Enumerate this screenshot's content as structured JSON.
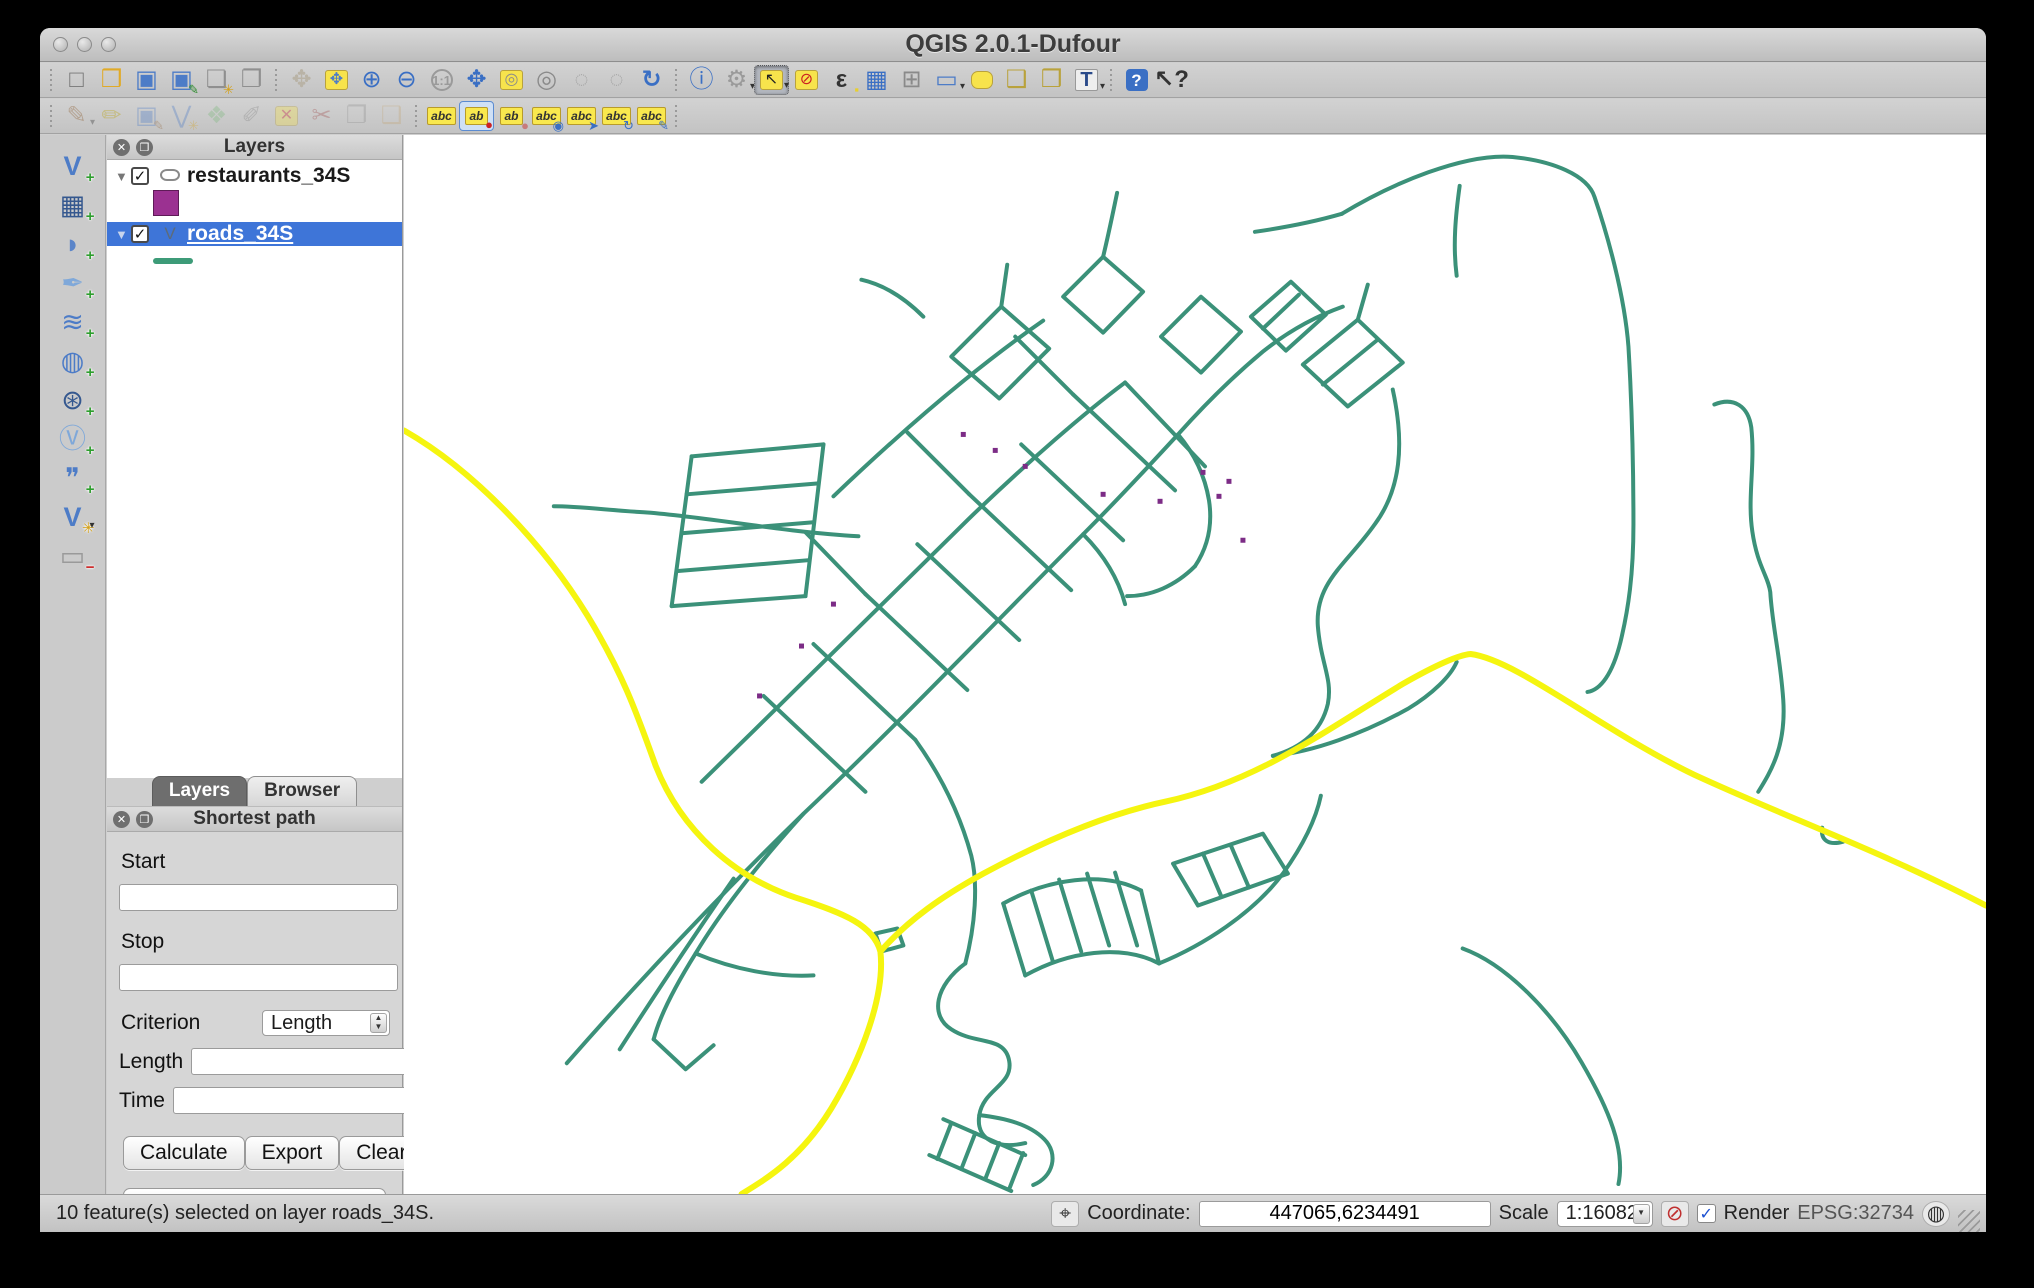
{
  "window": {
    "title": "QGIS 2.0.1-Dufour"
  },
  "toolbars": {
    "main": {
      "icons": [
        {
          "sep": true
        },
        {
          "name": "project-new",
          "glyph": "□",
          "fg": "#777"
        },
        {
          "name": "project-open",
          "glyph": "❒",
          "fg": "#e0aa28"
        },
        {
          "name": "project-save",
          "glyph": "▣",
          "fg": "#4d7cc7"
        },
        {
          "name": "project-save-as",
          "glyph": "▣",
          "fg": "#4d7cc7",
          "sub": "✎",
          "subc": "#2a8a2a"
        },
        {
          "name": "composer-new",
          "glyph": "❏",
          "fg": "#8f8f8f",
          "sub": "✳",
          "subc": "#d4a017"
        },
        {
          "name": "composer-manager",
          "glyph": "❐",
          "fg": "#8f8f8f"
        },
        {
          "sep": true
        },
        {
          "name": "pan-map",
          "glyph": "✥",
          "fg": "#b9b3a6"
        },
        {
          "name": "pan-to-selection",
          "glyph": "✥",
          "fg": "#4d7cc7",
          "chip": true
        },
        {
          "name": "zoom-in",
          "glyph": "⊕",
          "fg": "#3a6fc4"
        },
        {
          "name": "zoom-out",
          "glyph": "⊖",
          "fg": "#3a6fc4"
        },
        {
          "name": "zoom-native",
          "glyph": "1:1",
          "fg": "#9a9a9a",
          "cls": "txt"
        },
        {
          "name": "zoom-full-extent",
          "glyph": "✥",
          "fg": "#3a6fc4",
          "cls": "bold"
        },
        {
          "name": "zoom-to-selection",
          "glyph": "◎",
          "fg": "#8a8a8a",
          "chip": true
        },
        {
          "name": "zoom-to-layer",
          "glyph": "◎",
          "fg": "#8a8a8a"
        },
        {
          "name": "zoom-last",
          "glyph": "◌",
          "fg": "#a8a8a8"
        },
        {
          "name": "zoom-next",
          "glyph": "◌",
          "fg": "#a8a8a8"
        },
        {
          "name": "map-refresh",
          "glyph": "↻",
          "fg": "#3a6fc4",
          "cls": "bold"
        },
        {
          "sep": true
        },
        {
          "name": "identify-features",
          "glyph": "ⓘ",
          "fg": "#3a6fc4"
        },
        {
          "name": "run-feature-action",
          "glyph": "⚙",
          "fg": "#9a9a9a",
          "dd": true
        },
        {
          "name": "select-features-rectangle",
          "glyph": "↖",
          "fg": "#222",
          "chip": true,
          "active": true,
          "dd": true
        },
        {
          "name": "deselect-features",
          "glyph": "⊘",
          "fg": "#cc2222",
          "chip": true
        },
        {
          "name": "select-by-expression",
          "glyph": "ε",
          "fg": "#333",
          "cls": "bold",
          "sub": "▪",
          "subc": "#e8cf2e"
        },
        {
          "name": "attribute-table",
          "glyph": "▦",
          "fg": "#3a6fc4"
        },
        {
          "name": "field-calculator",
          "glyph": "⊞",
          "fg": "#8a8a8a"
        },
        {
          "name": "measure-line",
          "glyph": "▭",
          "fg": "#4d7cc7",
          "dd": true
        },
        {
          "name": "map-tips",
          "glyph": " ",
          "cls": "chip-round"
        },
        {
          "name": "bookmark-new",
          "glyph": "❑",
          "fg": "#b9a23c"
        },
        {
          "name": "bookmark-show",
          "glyph": "❒",
          "fg": "#b9a23c"
        },
        {
          "name": "text-annotation",
          "glyph": "T",
          "fg": "#2a4a8a",
          "cls": "txtT",
          "dd": true
        },
        {
          "sep": true
        },
        {
          "name": "help-contents",
          "glyph": "?",
          "fg": "#fff",
          "cls": "sq"
        },
        {
          "name": "whats-this",
          "glyph": "↖?",
          "fg": "#333",
          "cls": "bold"
        }
      ]
    },
    "edit": {
      "icons": [
        {
          "sep": true
        },
        {
          "name": "current-edits",
          "glyph": "✎",
          "fg": "#8b5a2b",
          "dd": true,
          "disabled": true
        },
        {
          "name": "toggle-editing",
          "glyph": "✏",
          "fg": "#b8a000",
          "disabled": true
        },
        {
          "name": "save-layer-edits",
          "glyph": "▣",
          "fg": "#4d7cc7",
          "disabled": true,
          "sub": "✎",
          "subc": "#8b5a2b"
        },
        {
          "name": "add-feature",
          "glyph": "⋁",
          "fg": "#4d7cc7",
          "disabled": true,
          "sub": "✳",
          "subc": "#d4a017"
        },
        {
          "name": "move-feature",
          "glyph": "❖",
          "fg": "#7cb87c",
          "disabled": true
        },
        {
          "name": "node-tool",
          "glyph": "✐",
          "fg": "#888",
          "disabled": true
        },
        {
          "name": "delete-selected",
          "glyph": "✕",
          "fg": "#cc2222",
          "chip": true,
          "disabled": true
        },
        {
          "name": "cut-features",
          "glyph": "✂",
          "fg": "#a05050",
          "disabled": true
        },
        {
          "name": "copy-features",
          "glyph": "❐",
          "fg": "#8f8f8f",
          "disabled": true
        },
        {
          "name": "paste-features",
          "glyph": "❑",
          "fg": "#c2a678",
          "disabled": true
        },
        {
          "sep": true
        },
        {
          "name": "labeling-options",
          "glyph": "abc",
          "cls": "label-chip"
        },
        {
          "name": "label-pin",
          "glyph": "ab",
          "cls": "label-chip",
          "sub": "●",
          "subc": "#cc2222",
          "checked": true
        },
        {
          "name": "label-highlight-pinned",
          "glyph": "ab",
          "cls": "label-chip",
          "sub": "●",
          "subc": "#c77b7b"
        },
        {
          "name": "label-show-hide",
          "glyph": "abc",
          "cls": "label-chip",
          "sub": "◉",
          "subc": "#3a6fc4"
        },
        {
          "name": "label-move",
          "glyph": "abc",
          "cls": "label-chip",
          "sub": "➤",
          "subc": "#3a6fc4"
        },
        {
          "name": "label-rotate",
          "glyph": "abc",
          "cls": "label-chip",
          "sub": "↻",
          "subc": "#3a6fc4"
        },
        {
          "name": "label-properties",
          "glyph": "abc",
          "cls": "label-chip",
          "sub": "✎",
          "subc": "#3a6fc4"
        },
        {
          "sep": true
        }
      ]
    },
    "layers_rail": {
      "icons": [
        {
          "name": "add-vector-layer",
          "glyph": "V",
          "fg": "#4d7cc7",
          "cls": "bold",
          "badge": "+",
          "badgec": "#2e9e2e"
        },
        {
          "name": "add-raster-layer",
          "glyph": "▦",
          "fg": "#35588f",
          "badge": "+",
          "badgec": "#2e9e2e"
        },
        {
          "name": "add-postgis-layer",
          "glyph": "◗",
          "fg": "#5b85c9",
          "badge": "+",
          "badgec": "#2e9e2e"
        },
        {
          "name": "add-spatialite-layer",
          "glyph": "✒",
          "fg": "#7fa8d9",
          "badge": "+",
          "badgec": "#2e9e2e"
        },
        {
          "name": "add-mssql-layer",
          "glyph": "≋",
          "fg": "#4d7cc7",
          "badge": "+",
          "badgec": "#2e9e2e"
        },
        {
          "name": "add-wms-layer",
          "glyph": "◍",
          "fg": "#4d7cc7",
          "badge": "+",
          "badgec": "#2e9e2e"
        },
        {
          "name": "add-wcs-layer",
          "glyph": "⊛",
          "fg": "#35588f",
          "badge": "+",
          "badgec": "#2e9e2e"
        },
        {
          "name": "add-wfs-layer",
          "glyph": "Ⓥ",
          "fg": "#7fa8d9",
          "badge": "+",
          "badgec": "#2e9e2e"
        },
        {
          "name": "add-delimited-text-layer",
          "glyph": "❞",
          "fg": "#4d7cc7",
          "badge": "+",
          "badgec": "#2e9e2e"
        },
        {
          "name": "new-shapefile-layer",
          "glyph": "V",
          "fg": "#4d7cc7",
          "cls": "bold",
          "badge": "✳",
          "badgec": "#d4a017",
          "dd": true
        },
        {
          "name": "remove-layer",
          "glyph": "▭",
          "fg": "#9a9a9a",
          "badge": "−",
          "badgec": "#cc2222"
        }
      ]
    }
  },
  "layers_panel": {
    "title": "Layers",
    "layers": [
      {
        "name": "restaurants_34S",
        "type": "point",
        "swatch": "#9b3191",
        "checked": true,
        "selected": false
      },
      {
        "name": "roads_34S",
        "type": "line",
        "swatch": "#3d9b78",
        "checked": true,
        "selected": true
      }
    ],
    "tabs": [
      {
        "label": "Layers",
        "active": true
      },
      {
        "label": "Browser",
        "active": false
      }
    ]
  },
  "shortest_path_panel": {
    "title": "Shortest path",
    "start_label": "Start",
    "start_value": "",
    "stop_label": "Stop",
    "stop_value": "",
    "criterion_label": "Criterion",
    "criterion_value": "Length",
    "length_label": "Length",
    "length_value": "",
    "time_label": "Time",
    "time_value": "",
    "buttons": {
      "calculate": "Calculate",
      "export": "Export",
      "clear": "Clear",
      "help": "Help"
    }
  },
  "status_bar": {
    "message": "10 feature(s) selected on layer roads_34S.",
    "coordinate_label": "Coordinate:",
    "coordinate_value": "447065,6234491",
    "scale_label": "Scale",
    "scale_value": "1:16082",
    "render_label": "Render",
    "render_checked": "✓",
    "crs": "EPSG:32734"
  },
  "map": {
    "background": "#ffffff",
    "road_color": "#3b9179",
    "selected_color": "#f5f50f",
    "restaurant_color": "#7c2c86",
    "teal_paths": [
      "M 939,79 C 990,48 1062,18 1110,22 C 1150,26 1185,40 1192,62 C 1205,100 1222,160 1226,212 C 1230,280 1231,330 1231,390 C 1231,440 1226,475 1218,508 C 1210,540 1198,556 1185,558",
      "M 1057,51 C 1053,80 1050,110 1054,141",
      "M 939,79 C 908,88 880,93 852,97",
      "M 1312,270 C 1332,262 1346,272 1349,293 C 1353,331 1345,363 1350,397 C 1355,432 1366,442 1368,458 C 1370,492 1378,522 1381,566 C 1384,612 1369,637 1356,658",
      "M 1420,694 C 1418,707 1427,712 1441,708",
      "M 1060,815 C 1104,831 1150,879 1179,929 C 1207,977 1223,1017 1216,1051",
      "M 990,255 C 1002,310 998,355 972,390 C 944,430 912,448 915,492 C 918,530 930,545 925,570 C 918,600 895,615 870,622",
      "M 870,622 C 910,618 960,600 1005,575 C 1030,560 1048,542 1054,528",
      "M 700,122 C 706,97 710,77 714,58",
      "M 775,300 C 800,272 830,242 860,217 C 885,197 912,182 940,172",
      "M 163,930 C 240,842 320,758 400,680 C 500,585 600,480 680,400 C 718,362 752,325 775,300",
      "M 298,648 C 388,560 478,470 565,385 C 625,327 683,277 722,248",
      "M 430,362 C 498,297 568,236 640,186",
      "M 360,562 L 462,658",
      "M 410,510 L 512,606",
      "M 462,460 L 564,556",
      "M 514,410 L 616,506",
      "M 566,360 L 668,456",
      "M 618,310 L 720,406",
      "M 670,260 L 772,356",
      "M 722,248 L 802,332",
      "M 462,460 L 402,398",
      "M 566,360 L 504,298",
      "M 670,260 L 612,202",
      "M 288,322 L 268,472",
      "M 420,310 L 402,462",
      "M 288,322 L 420,310",
      "M 283,360 L 415,349",
      "M 278,399 L 410,388",
      "M 273,437 L 405,426",
      "M 268,472 L 402,462",
      "M 548,222 L 598,172 L 646,214 L 596,264 Z",
      "M 660,162 L 700,122 L 740,157 L 700,198 Z",
      "M 758,202 L 798,162 L 838,197 L 798,238 Z",
      "M 848,182 L 888,147 L 923,180 L 883,216 Z",
      "M 860,194 L 896,160",
      "M 598,172 L 604,130",
      "M 520,182 C 500,162 480,150 458,145",
      "M 455,402 C 380,398 300,382 240,378 C 205,376 175,372 150,372",
      "M 400,680 C 362,722 322,770 292,820 C 272,852 256,882 250,906",
      "M 330,745 C 292,800 252,860 216,916",
      "M 250,906 L 282,936 L 310,912",
      "M 512,606 C 540,645 558,685 568,722 C 575,750 572,792 562,830",
      "M 600,770 C 645,745 700,737 738,757",
      "M 622,842 C 665,818 718,810 756,830",
      "M 600,770 L 622,842",
      "M 628,757 L 650,829",
      "M 656,746 L 678,818",
      "M 684,740 L 706,812",
      "M 712,739 L 734,812",
      "M 738,757 L 756,830",
      "M 770,730 L 860,700 L 885,740 L 795,772 Z",
      "M 800,720 L 818,762",
      "M 828,712 L 846,754",
      "M 562,830 C 532,852 526,882 548,896 C 572,912 602,902 606,928 C 610,952 580,956 576,982 C 572,1008 596,1016 622,1010",
      "M 540,986 L 622,1022",
      "M 526,1022 L 608,1058",
      "M 548,990 L 534,1026",
      "M 572,1000 L 558,1036",
      "M 596,1010 L 582,1046",
      "M 620,1020 L 606,1056",
      "M 576,982 C 602,985 626,991 641,1006 C 656,1021 650,1044 630,1052",
      "M 756,830 C 800,812 850,780 880,740 C 900,712 913,686 918,662",
      "M 472,800 L 494,795 L 500,812 L 478,818 Z",
      "M 292,820 C 330,836 372,844 410,842",
      "M 900,230 L 955,185 L 1000,228 L 945,272 Z",
      "M 920,250 L 975,205",
      "M 955,185 L 965,150",
      "M 775,300 C 792,320 802,342 806,366 C 810,392 804,414 792,432",
      "M 792,432 C 772,452 748,462 724,462",
      "M 680,400 C 700,420 715,444 722,470"
    ],
    "yellow_paths": [
      "M 0,296 C 70,336 140,410 184,482 C 218,538 232,576 252,632 C 278,698 332,744 392,764 C 442,780 470,792 477,818 C 482,862 458,925 428,975 C 398,1024 366,1044 338,1061",
      "M 477,818 C 505,786 540,762 580,740 C 645,705 705,680 762,668 C 855,648 925,595 1000,550 C 1035,530 1056,521 1068,520 C 1115,526 1200,597 1292,641 C 1385,684 1480,718 1584,772"
    ],
    "restaurant_points": [
      [
        560,
        300
      ],
      [
        592,
        316
      ],
      [
        622,
        332
      ],
      [
        700,
        360
      ],
      [
        757,
        367
      ],
      [
        800,
        338
      ],
      [
        826,
        347
      ],
      [
        816,
        362
      ],
      [
        840,
        406
      ],
      [
        430,
        470
      ],
      [
        398,
        512
      ],
      [
        356,
        562
      ]
    ]
  }
}
